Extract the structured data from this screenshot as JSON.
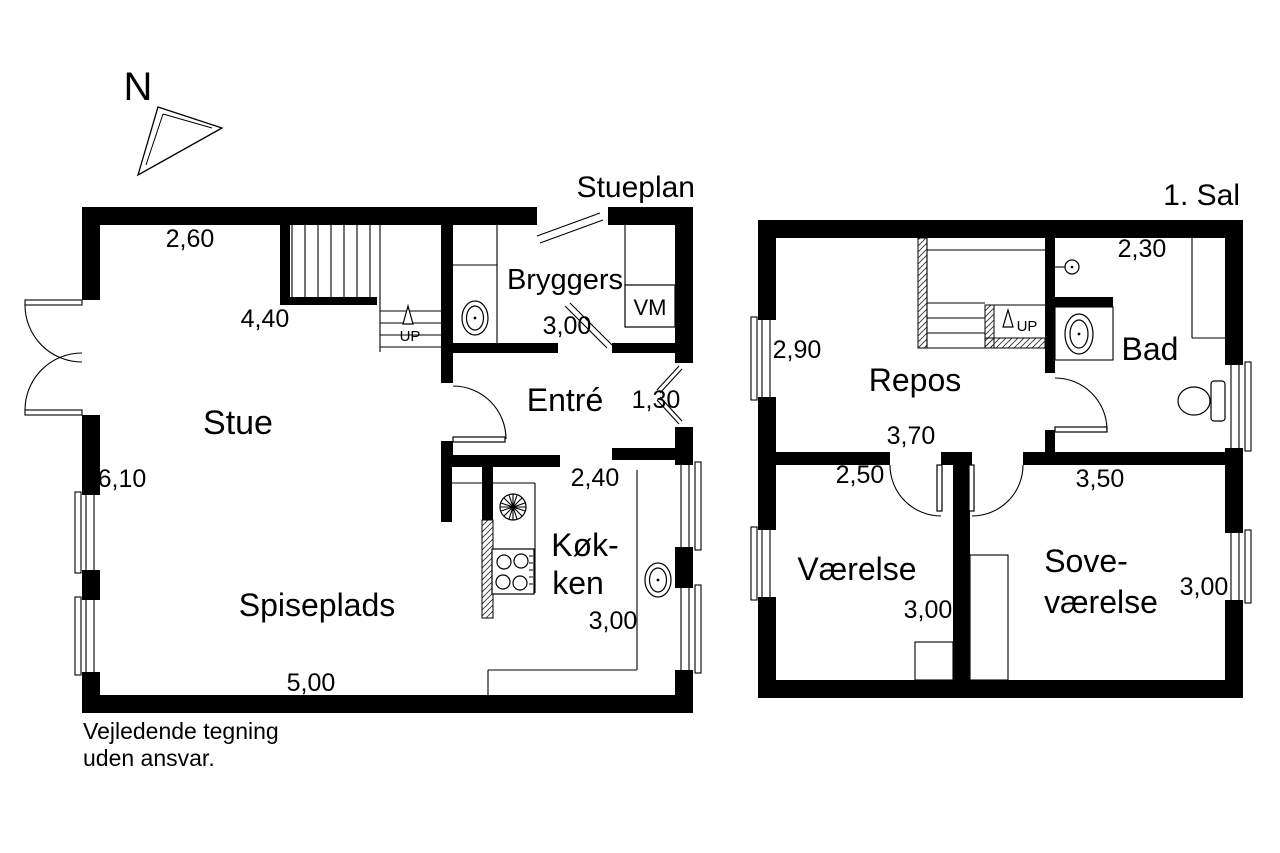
{
  "compass": {
    "label": "N"
  },
  "note": {
    "line1": "Vejledende tegning",
    "line2": "uden ansvar."
  },
  "colors": {
    "wall": "#000000",
    "background": "#ffffff",
    "line": "#000000"
  },
  "ground_floor": {
    "title": "Stueplan",
    "rooms": {
      "stue": "Stue",
      "spiseplads": "Spiseplads",
      "kokken_line1": "Køk-",
      "kokken_line2": "ken",
      "entre": "Entré",
      "bryggers": "Bryggers"
    },
    "labels": {
      "vm": "VM",
      "up": "UP"
    },
    "dimensions": {
      "top": "2,60",
      "stue_width": "4,40",
      "bryggers_width": "3,00",
      "front_door": "1,30",
      "kokken_width": "2,40",
      "left_wall": "6,10",
      "kokken_depth": "3,00",
      "bottom": "5,00"
    }
  },
  "first_floor": {
    "title": "1. Sal",
    "rooms": {
      "repos": "Repos",
      "bad": "Bad",
      "vaerelse": "Værelse",
      "sovevaerelse_line1": "Sove-",
      "sovevaerelse_line2": "værelse"
    },
    "labels": {
      "up": "UP"
    },
    "dimensions": {
      "left_wall": "2,90",
      "bad_width": "2,30",
      "repos_width": "3,70",
      "vaerelse_width": "2,50",
      "sovevaerelse_width": "3,50",
      "vaerelse_depth": "3,00",
      "sovevaerelse_depth": "3,00"
    }
  }
}
